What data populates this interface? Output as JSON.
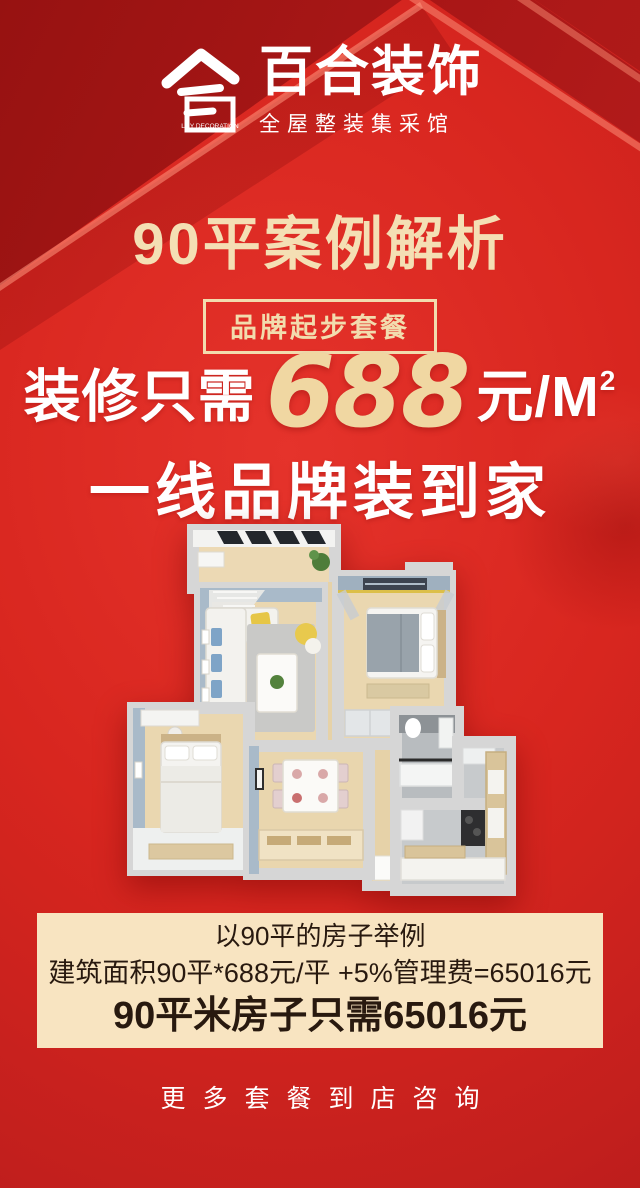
{
  "brand": {
    "name": "百合装饰",
    "tagline": "全屋整装集采馆",
    "logo_label": "LILY DECORATION"
  },
  "title": "90平案例解析",
  "badge": "品牌起步套餐",
  "headline": {
    "prefix": "装修只需",
    "price": "688",
    "unit": "元/M",
    "unit_sup": "2",
    "line2": "一线品牌装到家"
  },
  "example_box": {
    "line1": "以90平的房子举例",
    "line2": "建筑面积90平*688元/平 +5%管理费=65016元",
    "line3": "90平米房子只需65016元"
  },
  "footer": {
    "cta": "更多套餐到店咨询"
  },
  "floorplan": {
    "type": "3d-top-down-apartment-render",
    "rooms": [
      "balcony",
      "living-room",
      "master-bedroom",
      "second-bedroom",
      "dining-area",
      "bathroom",
      "kitchen",
      "hallway"
    ]
  },
  "colors": {
    "background_red": "#d8261f",
    "dark_ribbon_red": "#a81616",
    "cream_box": "#f8e4c1",
    "gold_title": "#f4dfb4",
    "price_gold": "#f0d7a2",
    "dark_text": "#28190f",
    "white": "#ffffff"
  }
}
